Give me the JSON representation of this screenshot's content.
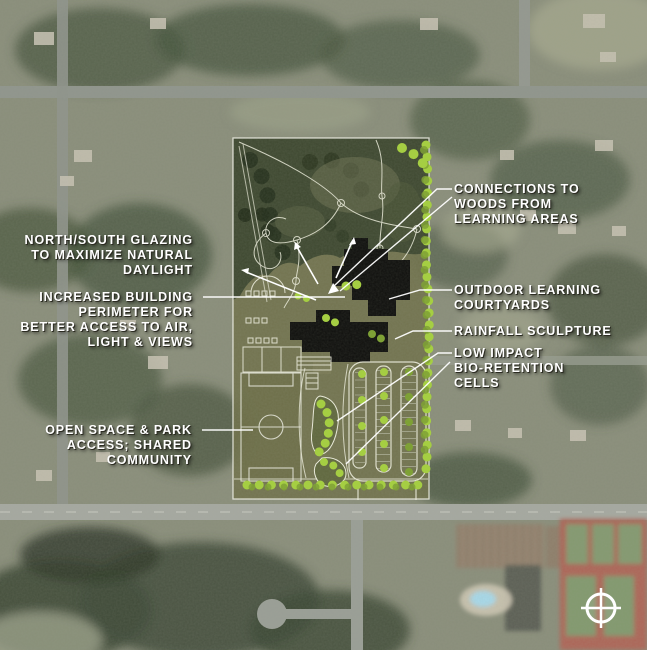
{
  "annotations": {
    "connections": {
      "label": "CONNECTIONS TO\nWOODS FROM\nLEARNING AREAS"
    },
    "glazing": {
      "label": "NORTH/SOUTH GLAZING\nTO MAXIMIZE NATURAL\nDAYLIGHT"
    },
    "perimeter": {
      "label": "INCREASED BUILDING\nPERIMETER FOR\nBETTER ACCESS TO AIR,\nLIGHT & VIEWS"
    },
    "courtyards": {
      "label": "OUTDOOR LEARNING\nCOURTYARDS"
    },
    "rainfall": {
      "label": "RAINFALL SCULPTURE"
    },
    "bioretention": {
      "label": "LOW IMPACT\nBIO-RETENTION\nCELLS"
    },
    "openspace": {
      "label": "OPEN SPACE & PARK\nACCESS; SHARED\nCOMMUNITY"
    }
  },
  "icons": {
    "north_arrow": "circle-with-cross compass symbol, bottom right"
  },
  "colors": {
    "annotation-text": "#ffffff",
    "plan-ground": "#70714a",
    "building": "#0e0e0c",
    "tree-accent": "#a6d23c",
    "tree-accent-dark": "#7ca12e",
    "plan-line": "#eeeede"
  }
}
